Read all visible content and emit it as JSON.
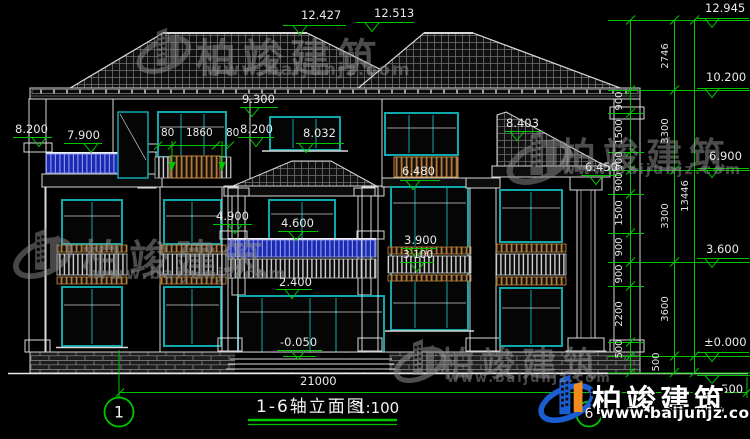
{
  "drawing": {
    "title": "1-6轴立面图",
    "scale": "1:100",
    "total_width": "21000",
    "axis_start": "1",
    "axis_end": "6"
  },
  "levels": {
    "v12427": "12.427",
    "v12513": "12.513",
    "v12945": "12.945",
    "v10200": "10.200",
    "v9300": "9.300",
    "v8200": "8.200",
    "v7900": "7.900",
    "v8032": "8.032",
    "v8403": "8.403",
    "v6900": "6.900",
    "v6480": "6.480",
    "v6450": "6.450",
    "v4900": "4.900",
    "v4600": "4.600",
    "v3900": "3.900",
    "v3100": "3.100",
    "v3600": "3.600",
    "v2400": "2.400",
    "vzero": "±0.000",
    "vn0050": "-0.050",
    "vn0500": "-0.500"
  },
  "dims": {
    "d2746": "2746",
    "d900": "900",
    "d1500": "1500",
    "d2200": "2200",
    "d500": "500",
    "d3300": "3300",
    "d3600": "3600",
    "d13446": "13446",
    "w80": "80",
    "w1860": "1860"
  },
  "watermark": {
    "brand": "柏竣建筑",
    "site": "www.baijunjz.com"
  },
  "logo": {
    "brand": "柏竣建筑",
    "site": "www.baijunjz.com"
  },
  "colors": {
    "dim_green": "#00c600",
    "frame_teal": "#10a8ac",
    "railing_blue": "#2230bb",
    "railing_tan": "#c08a40",
    "logo_blue": "#1b5ed2",
    "logo_orange": "#f08c1e",
    "line_white": "#d9d9d9",
    "background": "#000000"
  }
}
